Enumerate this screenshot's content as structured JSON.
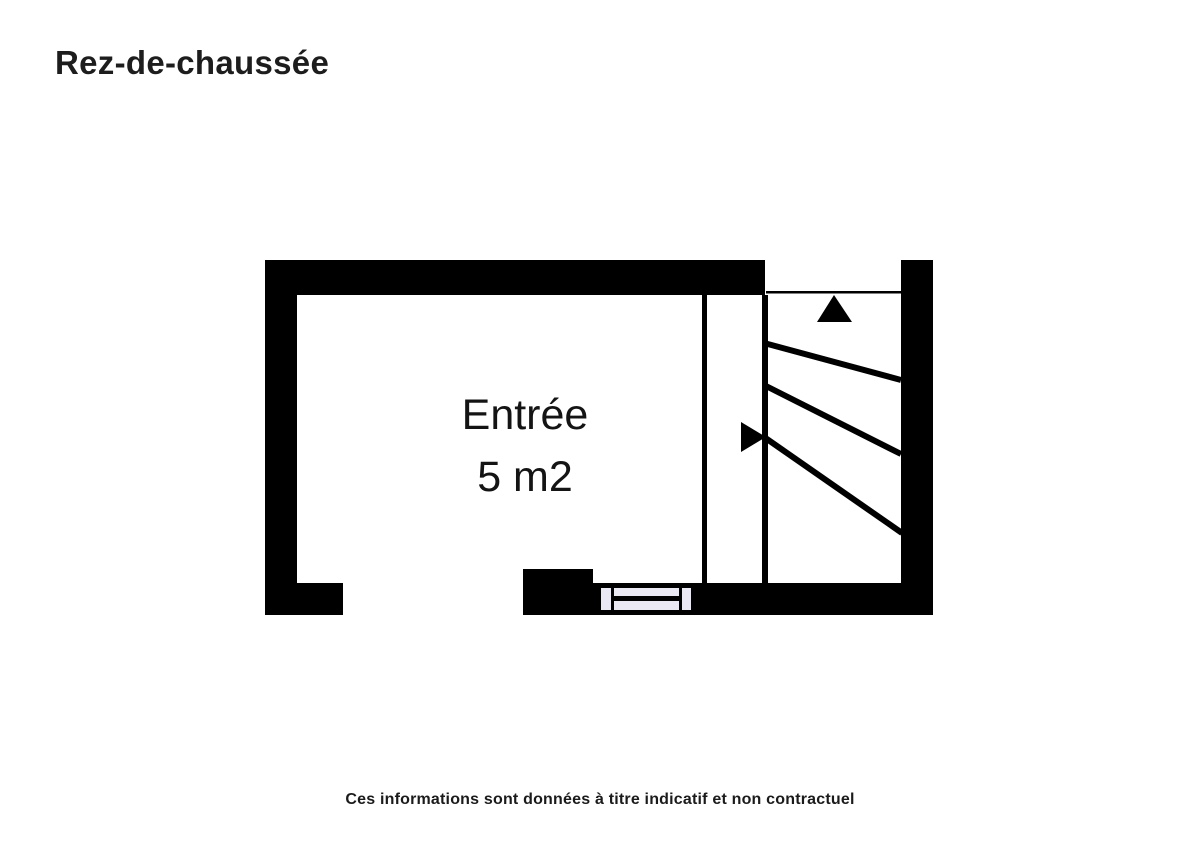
{
  "header": {
    "title": "Rez-de-chaussée"
  },
  "floor_plan": {
    "room": {
      "name": "Entrée",
      "area": "5 m2"
    },
    "icons": [
      "stairs-up-arrow-icon",
      "stairs-direction-arrow-icon",
      "window-symbol"
    ],
    "colors": {
      "wall": "#000000",
      "window_fill": "#e9e8f3",
      "background": "#ffffff",
      "text": "#1d1d1d"
    }
  },
  "footer": {
    "disclaimer": "Ces informations sont données à titre indicatif et non contractuel"
  }
}
